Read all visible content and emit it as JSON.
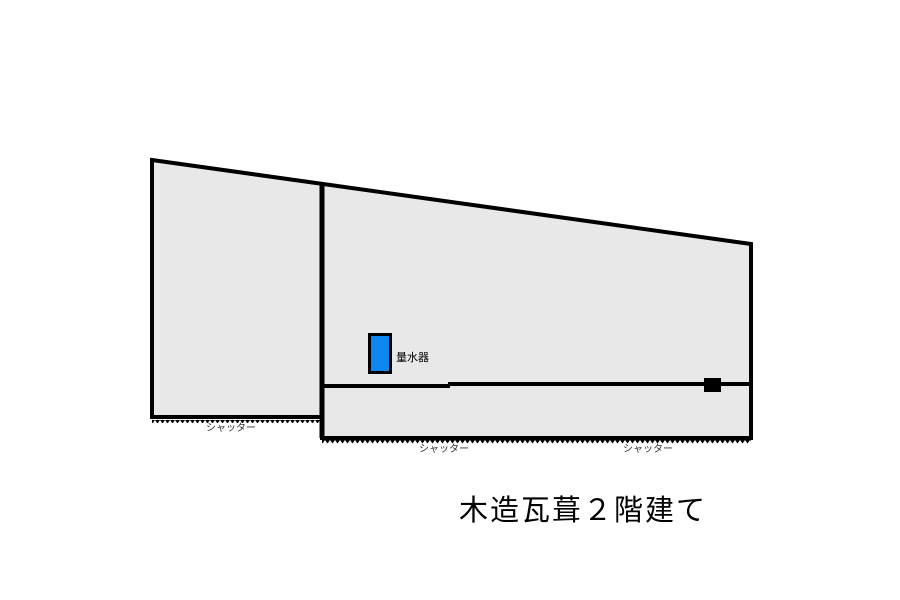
{
  "diagram": {
    "title": "木造瓦葺２階建て",
    "building": {
      "type": "floor-plan-footprint",
      "fill_color": "#e8e8e8",
      "outline_color": "#000000"
    },
    "water_meter": {
      "label": "量水器",
      "fill_color": "#0d86f0"
    },
    "shutters": [
      {
        "label": "シャッター",
        "position": "left-section-bottom"
      },
      {
        "label": "シャッター",
        "position": "middle-section-bottom"
      },
      {
        "label": "シャッター",
        "position": "right-section-bottom"
      }
    ],
    "marker": {
      "name": "wall-opening-marker",
      "color": "#000000"
    },
    "background_color": "#ffffff"
  }
}
